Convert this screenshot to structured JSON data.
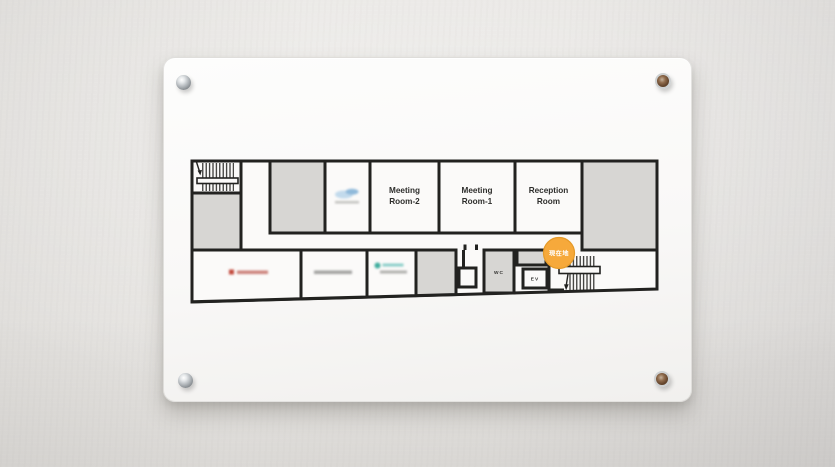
{
  "floor_sign": {
    "rooms": {
      "meeting_room_2": {
        "line1": "Meeting",
        "line2": "Room-2"
      },
      "meeting_room_1": {
        "line1": "Meeting",
        "line2": "Room-1"
      },
      "reception_room": {
        "line1": "Reception",
        "line2": "Room"
      },
      "toilet": {
        "label": "WC"
      },
      "elevator": {
        "label": "EV"
      }
    },
    "marker": {
      "label": "現在地",
      "color": "#F6A93B",
      "border_color": "#E59A28",
      "text_color": "#FFFFFF"
    },
    "colors": {
      "wall_line": "#222220",
      "room_fill_gray": "#D7D6D3",
      "plate_white": "#FBFAF9",
      "logo_red": "#C2493E",
      "logo_red_light": "#CC837B",
      "logo_blue": "#8FB9DA",
      "logo_blue_light": "#C2DAEC",
      "logo_teal": "#3FAE9F",
      "logo_teal_light": "#8CCFC9",
      "blurred_text_gray": "#A3A3A1"
    },
    "icons": {
      "stairs_top_left": "stairs-icon",
      "stairs_bottom_right": "stairs-icon",
      "screw_top_left": "standoff-screw",
      "screw_top_right": "standoff-screw",
      "screw_bottom_left": "standoff-screw",
      "screw_bottom_right": "standoff-screw"
    }
  }
}
